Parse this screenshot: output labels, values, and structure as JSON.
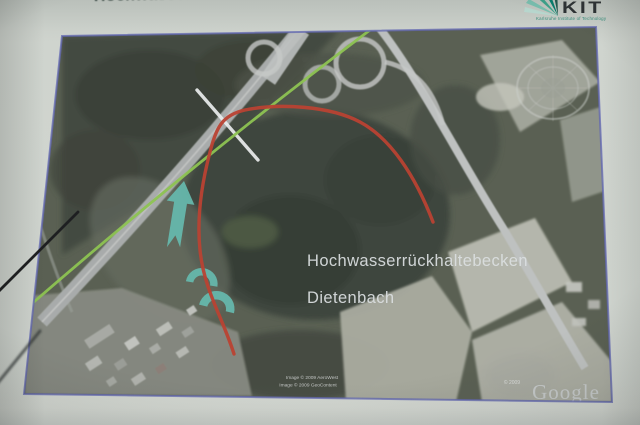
{
  "slide": {
    "title": "Hochwasserrückhaltebecken Dietenbach"
  },
  "kit_logo": {
    "acronym": "KIT",
    "subtitle": "Karlsruhe Institute of Technology",
    "brand_green": "#009682"
  },
  "map": {
    "label_line1": "Hochwasserrückhaltebecken",
    "label_line2": "Dietenbach",
    "credit_line1": "Image © 2009 AeroWest",
    "credit_line2": "Image © 2009 GeoContent",
    "watermark_year": "© 2009",
    "watermark_brand": "Google",
    "colors": {
      "basin_outline": "#d13b27",
      "route_line": "#86c93c",
      "flow_arrow": "#56bdae",
      "survey_line": "#edf0f1",
      "image_border": "#5f66c6"
    }
  }
}
